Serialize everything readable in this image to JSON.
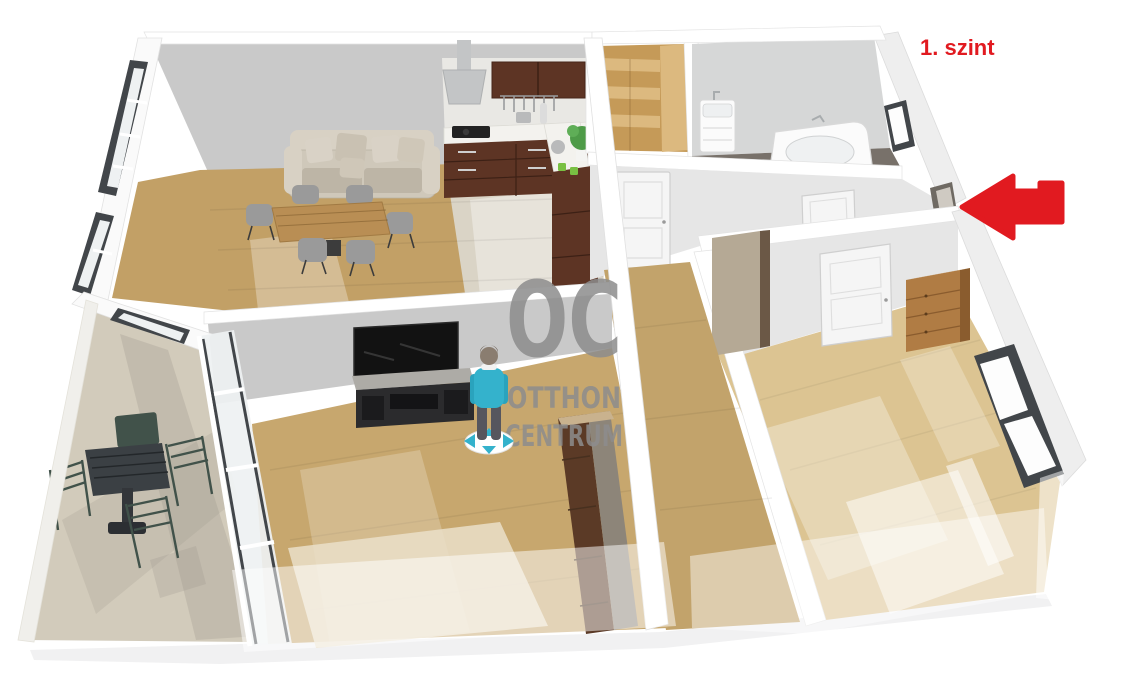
{
  "floor_label": {
    "text": "1. szint"
  },
  "watermark": {
    "line1": "OC",
    "line2": "OTTHON",
    "line3": "CENTRUM"
  },
  "direction_arrow": {
    "shape": "left-arrow"
  },
  "colors": {
    "bg": "#ffffff",
    "red": "#e11a20",
    "watermark": "#8d8d8d",
    "wallGray": "#c9c9c9",
    "wallBath": "#d6d7d7",
    "wallLight": "#e6e6e6",
    "wallLighter": "#eeeeee",
    "wallWhite": "#fafafa",
    "capWhite": "#ffffff",
    "capEdge": "#e0e0e0",
    "splash": "#e9e8e4",
    "woodDining": "#c2a066",
    "woodTV": "#c7a76e",
    "woodCorridor": "#c2a36b",
    "woodBedroom": "#dcc492",
    "stairDark": "#c59a58",
    "stairLight": "#dcb97f",
    "tileKitchen": "#dad4c6",
    "tileTerrace": "#d2cbbb",
    "tileBath": "#78716a",
    "shadowSoft": "#f1f1f2",
    "cabinetDark": "#5d3424",
    "cabinetDark2": "#47261a",
    "counterWhite": "#f3f2ee",
    "hoodGray": "#c3c5c6",
    "applianceDark": "#222222",
    "sofa": "#cfc8ba",
    "sofaDark": "#bdb5a6",
    "sofaLight": "#d8d1c4",
    "tableWood": "#b98e54",
    "chairGray": "#9a9a9a",
    "chairDark": "#3c3c3c",
    "tv": "#121212",
    "standTop": "#adaba6",
    "standBody": "#2b2b2d",
    "standGap": "#141416",
    "personTeal": "#34b2cc",
    "personTealDark": "#2aa3bd",
    "pants": "#56565e",
    "skin": "#8a7d70",
    "hair": "#6f6257",
    "discWhite": "#ffffff",
    "terraceTable": "#3b4044",
    "terraceChair": "#41524a",
    "chest": "#b07c44",
    "chestDark": "#8a5c2e",
    "chestTop": "#c89a60",
    "cabinetTan": "#b5a995",
    "cabinetTanDark": "#6b5846",
    "wardrobeGray": "#8d8579",
    "wardrobeSide": "#6e675c",
    "wardrobeWood": "#5b3a26",
    "wardrobeTop": "#c9b28e",
    "frameDark": "#42464a",
    "glass": "#eef1f2",
    "plantGreen": "#4e9b48",
    "plantLight": "#79c043",
    "metalGray": "#b9babb",
    "doorWhite": "#f5f5f5",
    "doorEdge": "#cfcfcf",
    "entryDark": "#6f6a63",
    "bathFixture": "#fbfbfb",
    "fixtureEdge": "#d8d8d8",
    "terraceShadow": "#9b958a"
  }
}
